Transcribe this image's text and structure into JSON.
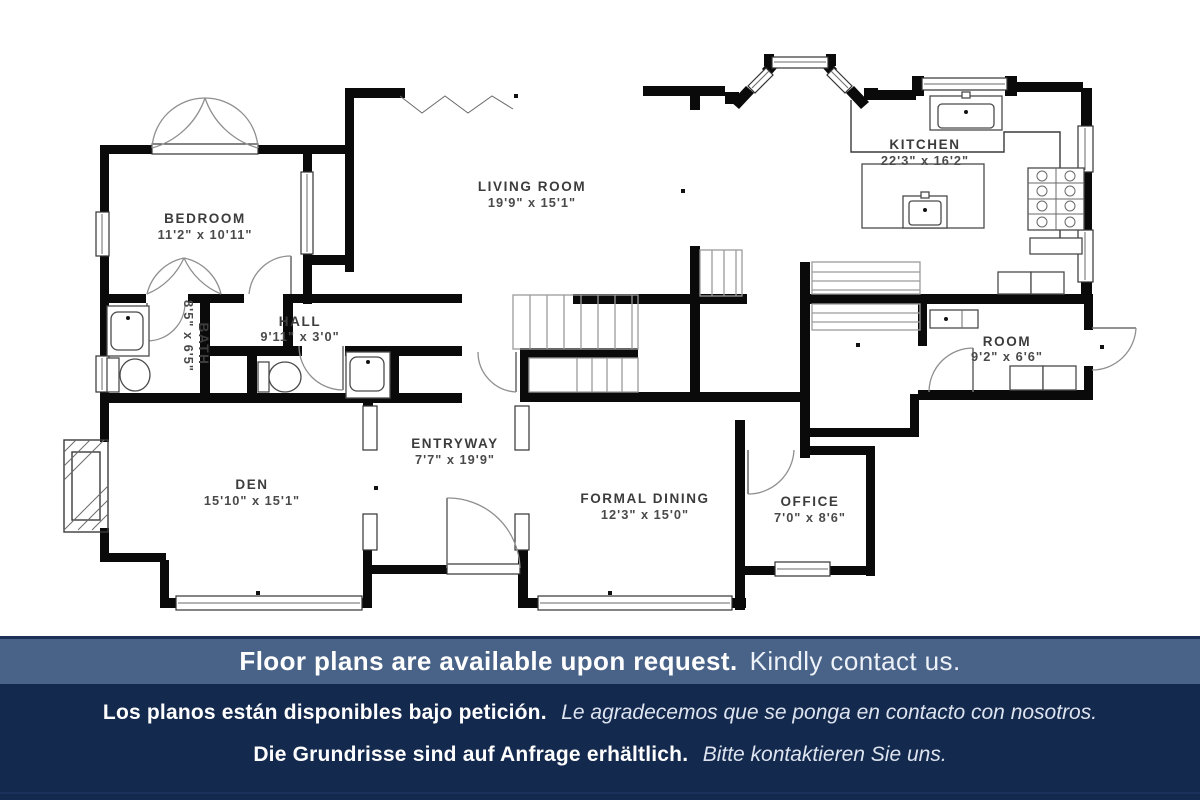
{
  "plan": {
    "rooms": [
      {
        "name": "BEDROOM",
        "dims": "11'2\" x 10'11\""
      },
      {
        "name": "LIVING ROOM",
        "dims": "19'9\" x 15'1\""
      },
      {
        "name": "KITCHEN",
        "dims": "22'3\" x 16'2\""
      },
      {
        "name": "HALL",
        "dims": "9'11\" x 3'0\""
      },
      {
        "name": "BATH",
        "dims": "8'5\" x 6'5\""
      },
      {
        "name": "ROOM",
        "dims": "9'2\" x 6'6\""
      },
      {
        "name": "DEN",
        "dims": "15'10\" x 15'1\""
      },
      {
        "name": "ENTRYWAY",
        "dims": "7'7\" x 19'9\""
      },
      {
        "name": "FORMAL DINING",
        "dims": "12'3\" x 15'0\""
      },
      {
        "name": "OFFICE",
        "dims": "7'0\" x 8'6\""
      }
    ]
  },
  "banners": {
    "primary_bold": "Floor plans are available upon request.",
    "primary_regular": "Kindly contact us.",
    "spanish_bold": "Los planos están disponibles bajo petición.",
    "spanish_italic": "Le agradecemos que se ponga en contacto con nosotros.",
    "german_bold": "Die Grundrisse sind auf Anfrage erhältlich.",
    "german_italic": "Bitte kontaktieren Sie uns."
  },
  "colors": {
    "banner_steel_blue": "#486288",
    "banner_navy": "#14294e",
    "accent_line_navy": "#1d3057",
    "plan_ink": "#000000"
  }
}
